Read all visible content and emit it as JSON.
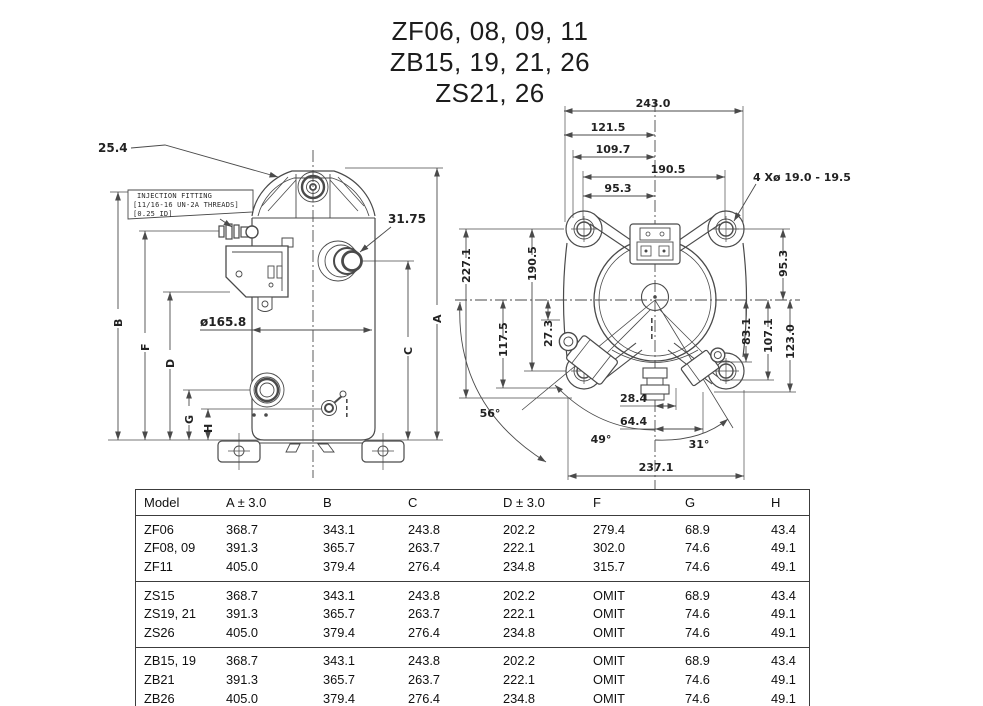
{
  "title": {
    "line1": "ZF06, 08, 09, 11",
    "line2": "ZB15, 19, 21, 26",
    "line3": "ZS21, 26"
  },
  "side_view": {
    "dim_25_4": "25.4",
    "dim_31_75": "31.75",
    "dim_diameter": "ø165.8",
    "injection_note_line1": "INJECTION FITTING",
    "injection_note_line2": "[11/16-16 UN-2A THREADS]",
    "injection_note_line3": "[0.25 ID]",
    "letters": {
      "a": "A",
      "b": "B",
      "c": "C",
      "d": "D",
      "f": "F",
      "g": "G",
      "h": "H"
    }
  },
  "top_view": {
    "dim_243": "243.0",
    "dim_121_5": "121.5",
    "dim_109_7": "109.7",
    "dim_190_5_h": "190.5",
    "dim_95_3_h": "95.3",
    "holes_note": "4 Xø 19.0 - 19.5",
    "dim_227_1": "227.1",
    "dim_190_5_v": "190.5",
    "dim_117_5": "117.5",
    "dim_27_3": "27.3",
    "dim_95_3_v": "95.3",
    "dim_83_1": "83.1",
    "dim_107_1": "107.1",
    "dim_123_0": "123.0",
    "dim_28_4": "28.4",
    "dim_64_4": "64.4",
    "dim_237_1": "237.1",
    "angle_56": "56°",
    "angle_49": "49°",
    "angle_31": "31°"
  },
  "table": {
    "headers": [
      "Model",
      "A ± 3.0",
      "B",
      "C",
      "D ± 3.0",
      "F",
      "G",
      "H"
    ],
    "groups": [
      {
        "rows": [
          [
            "ZF06",
            "368.7",
            "343.1",
            "243.8",
            "202.2",
            "279.4",
            "68.9",
            "43.4"
          ],
          [
            "ZF08, 09",
            "391.3",
            "365.7",
            "263.7",
            "222.1",
            "302.0",
            "74.6",
            "49.1"
          ],
          [
            "ZF11",
            "405.0",
            "379.4",
            "276.4",
            "234.8",
            "315.7",
            "74.6",
            "49.1"
          ]
        ]
      },
      {
        "rows": [
          [
            "ZS15",
            "368.7",
            "343.1",
            "243.8",
            "202.2",
            "OMIT",
            "68.9",
            "43.4"
          ],
          [
            "ZS19, 21",
            "391.3",
            "365.7",
            "263.7",
            "222.1",
            "OMIT",
            "74.6",
            "49.1"
          ],
          [
            "ZS26",
            "405.0",
            "379.4",
            "276.4",
            "234.8",
            "OMIT",
            "74.6",
            "49.1"
          ]
        ]
      },
      {
        "rows": [
          [
            "ZB15, 19",
            "368.7",
            "343.1",
            "243.8",
            "202.2",
            "OMIT",
            "68.9",
            "43.4"
          ],
          [
            "ZB21",
            "391.3",
            "365.7",
            "263.7",
            "222.1",
            "OMIT",
            "74.6",
            "49.1"
          ],
          [
            "ZB26",
            "405.0",
            "379.4",
            "276.4",
            "234.8",
            "OMIT",
            "74.6",
            "49.1"
          ]
        ]
      }
    ]
  },
  "colors": {
    "line": "#4a4a4a",
    "text": "#1f1f1f"
  }
}
